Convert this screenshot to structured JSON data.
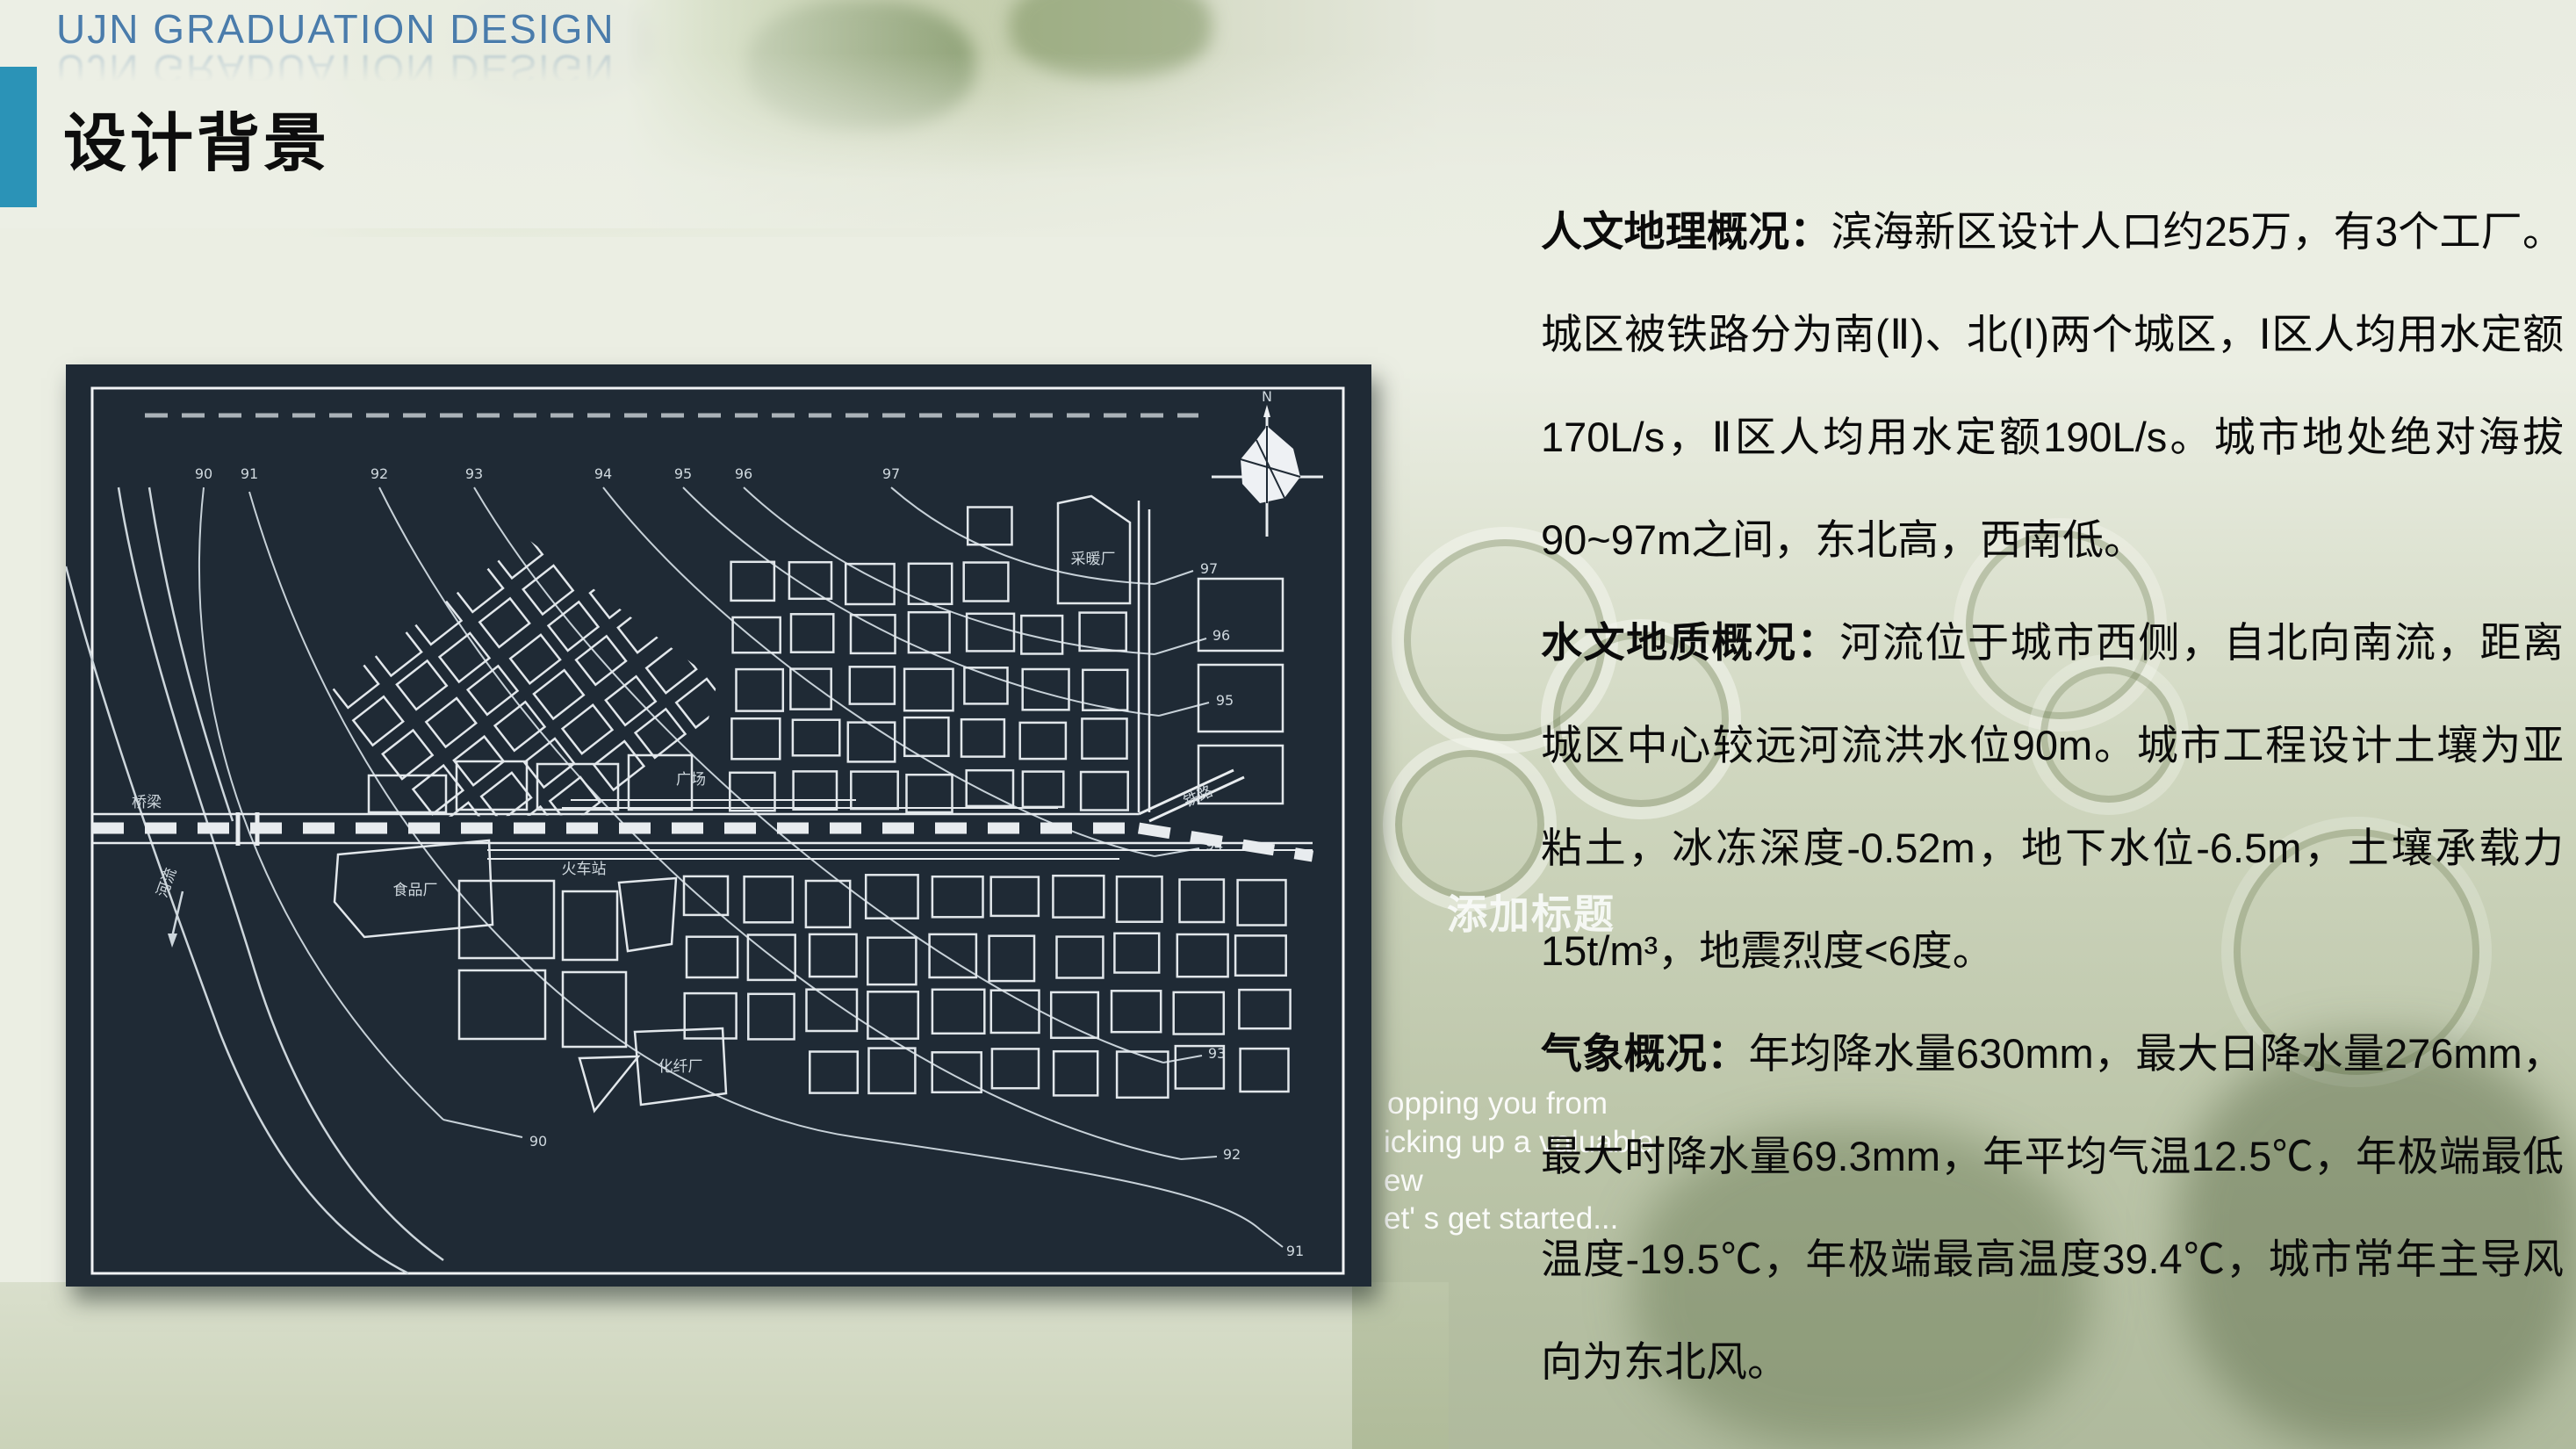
{
  "header": {
    "brand": "UJN GRADUATION DESIGN",
    "page_title": "设计背景"
  },
  "content": {
    "paragraphs": [
      {
        "lead": "人文地理概况：",
        "body": "滨海新区设计人口约25万，有3个工厂。城区被铁路分为南(Ⅱ)、北(Ⅰ)两个城区，Ⅰ区人均用水定额170L/s，Ⅱ区人均用水定额190L/s。城市地处绝对海拔90~97m之间，东北高，西南低。"
      },
      {
        "lead": "水文地质概况：",
        "body": "河流位于城市西侧，自北向南流，距离城区中心较远河流洪水位90m。城市工程设计土壤为亚粘土，冰冻深度-0.52m，地下水位-6.5m，土壤承载力15t/m³，地震烈度<6度。"
      },
      {
        "lead": "气象概况：",
        "body": "年均降水量630mm，最大日降水量276mm，最大时降水量69.3mm，年平均气温12.5℃，年极端最低温度-19.5℃，年极端最高温度39.4℃，城市常年主导风向为东北风。"
      }
    ]
  },
  "ghost": {
    "placeholder_title": "添加标题",
    "fragments": [
      "opping you from",
      "icking up a valuable",
      "ew",
      "et' s get started..."
    ]
  },
  "map": {
    "labels": {
      "heating_plant": "采暖厂",
      "square": "广场",
      "railway": "铁路",
      "train_station": "火车站",
      "food_factory": "食品厂",
      "chemical_fiber_plant": "化纤厂",
      "bridge": "桥梁",
      "river": "河流",
      "north": "N"
    },
    "contour_top_labels": [
      "90",
      "91",
      "92",
      "93",
      "94",
      "95",
      "96",
      "97"
    ],
    "contour_right_labels": [
      "97",
      "96",
      "95",
      "94",
      "93",
      "92",
      "91"
    ],
    "contour_bottom_label": "90"
  },
  "colors": {
    "accent_teal": "#2b93b7",
    "brand_blue": "#4a7cab",
    "map_bg": "#1f2a35",
    "map_line": "#e2e7eb",
    "body_text": "#0b0b0b"
  }
}
